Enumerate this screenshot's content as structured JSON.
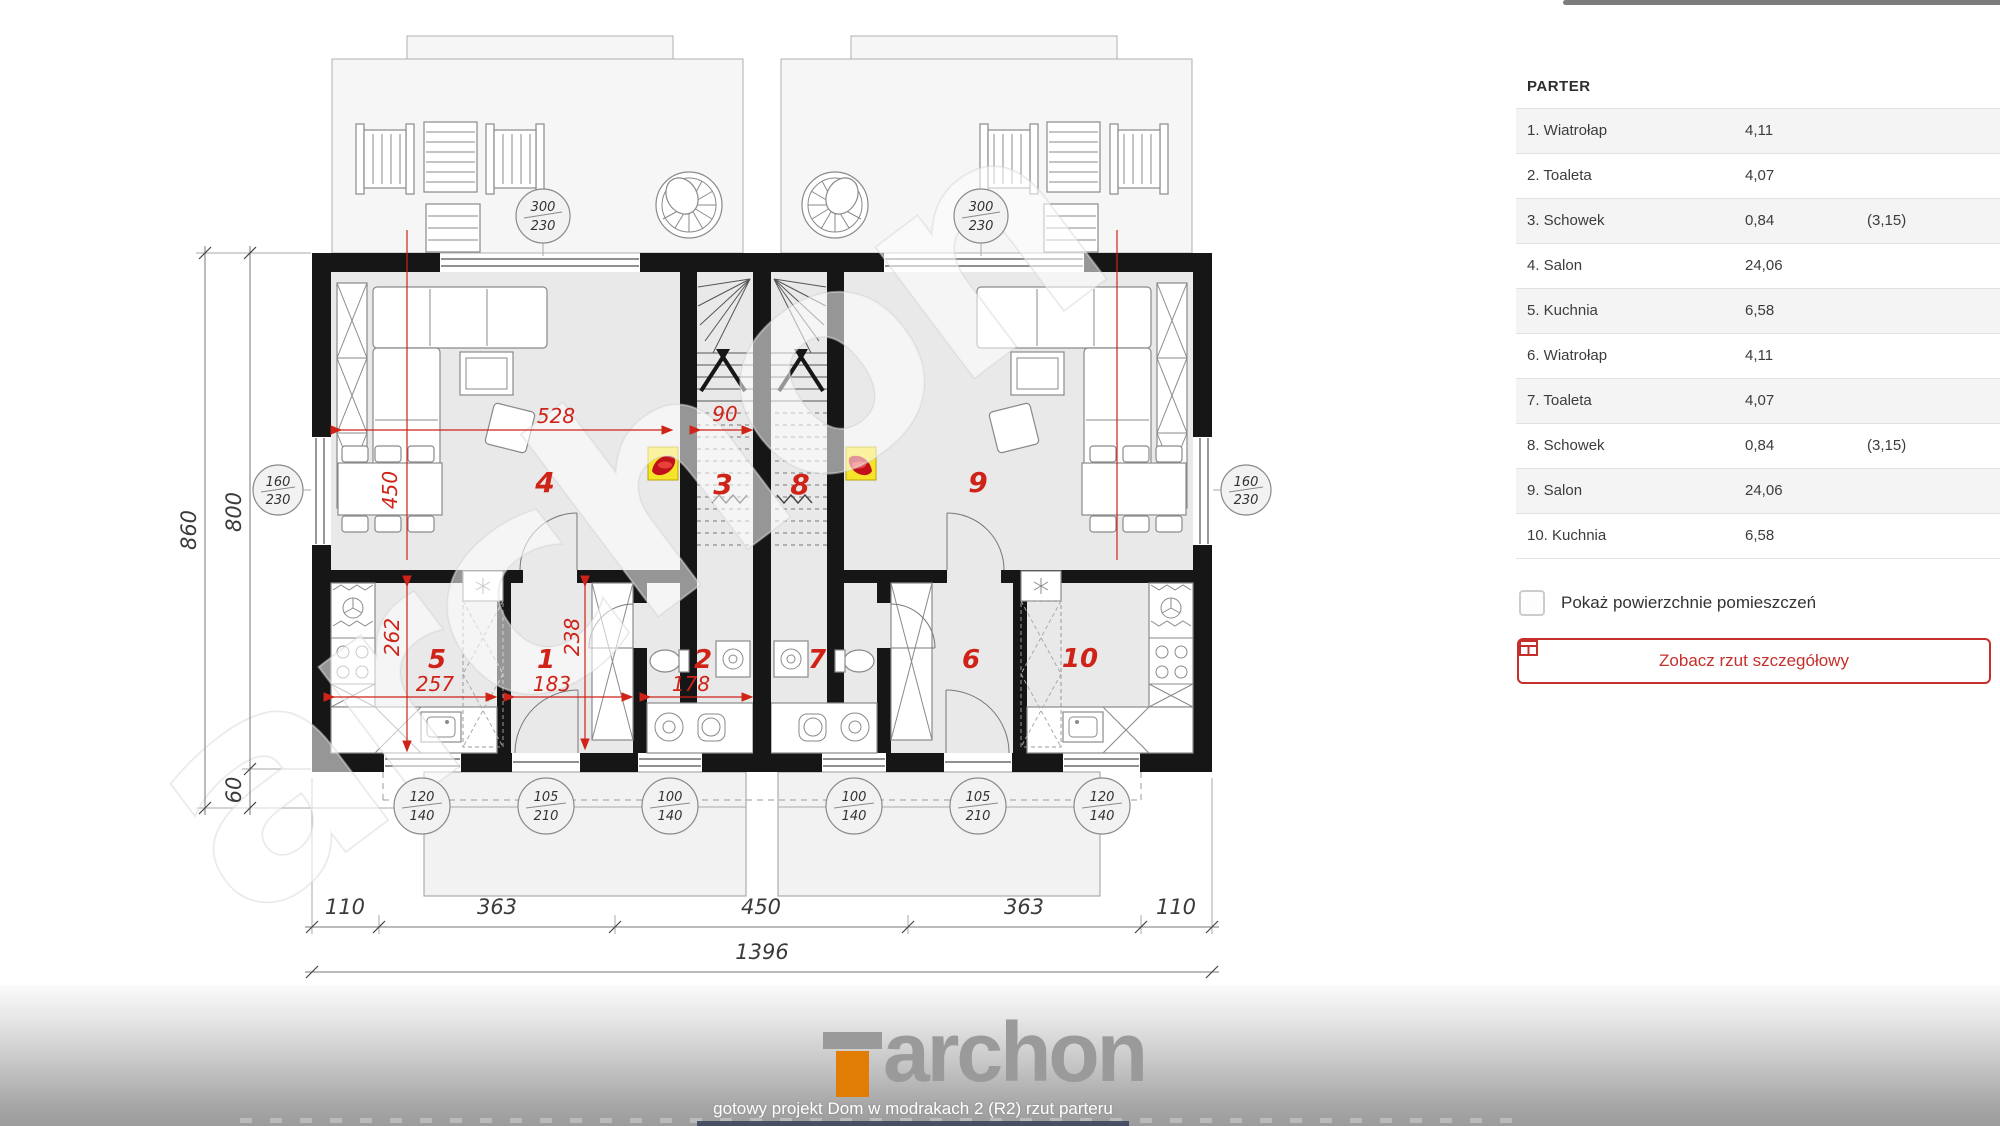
{
  "sidebar": {
    "title": "PARTER",
    "rows": [
      {
        "name": "1. Wiatrołap",
        "area": "4,11",
        "extra": ""
      },
      {
        "name": "2. Toaleta",
        "area": "4,07",
        "extra": ""
      },
      {
        "name": "3. Schowek",
        "area": "0,84",
        "extra": "(3,15)"
      },
      {
        "name": "4. Salon",
        "area": "24,06",
        "extra": ""
      },
      {
        "name": "5. Kuchnia",
        "area": "6,58",
        "extra": ""
      },
      {
        "name": "6. Wiatrołap",
        "area": "4,11",
        "extra": ""
      },
      {
        "name": "7. Toaleta",
        "area": "4,07",
        "extra": ""
      },
      {
        "name": "8. Schowek",
        "area": "0,84",
        "extra": "(3,15)"
      },
      {
        "name": "9. Salon",
        "area": "24,06",
        "extra": ""
      },
      {
        "name": "10. Kuchnia",
        "area": "6,58",
        "extra": ""
      }
    ],
    "checkbox_label": "Pokaż powierzchnie pomieszczeń",
    "button_label": "Zobacz rzut szczegółowy"
  },
  "footer": {
    "brand": "archon",
    "caption": "gotowy projekt Dom w modrakach 2 (R2) rzut parteru"
  },
  "plan": {
    "watermark": "archon",
    "accent_red": "#cf2318",
    "gas_yellow": "#f5e42a",
    "rooms": {
      "r1": "1",
      "r2": "2",
      "r3": "3",
      "r4": "4",
      "r5": "5",
      "r6": "6",
      "r7": "7",
      "r8": "8",
      "r9": "9",
      "r10": "10"
    },
    "dims": {
      "d528": "528",
      "d90": "90",
      "d450": "450",
      "d262": "262",
      "d257": "257",
      "d183": "183",
      "d238": "238",
      "d178": "178"
    },
    "windows": {
      "tl_w": "300",
      "tl_h": "230",
      "tr_w": "300",
      "tr_h": "230",
      "sl_w": "160",
      "sl_h": "230",
      "sr_w": "160",
      "sr_h": "230",
      "b1w": "120",
      "b1h": "140",
      "b2w": "105",
      "b2h": "210",
      "b3w": "100",
      "b3h": "140",
      "b4w": "100",
      "b4h": "140",
      "b5w": "105",
      "b5h": "210",
      "b6w": "120",
      "b6h": "140"
    },
    "chain": {
      "c1": "110",
      "c2": "363",
      "c3": "450",
      "c4": "363",
      "c5": "110",
      "total": "1396",
      "left1": "860",
      "left2": "800",
      "left3": "60"
    }
  }
}
